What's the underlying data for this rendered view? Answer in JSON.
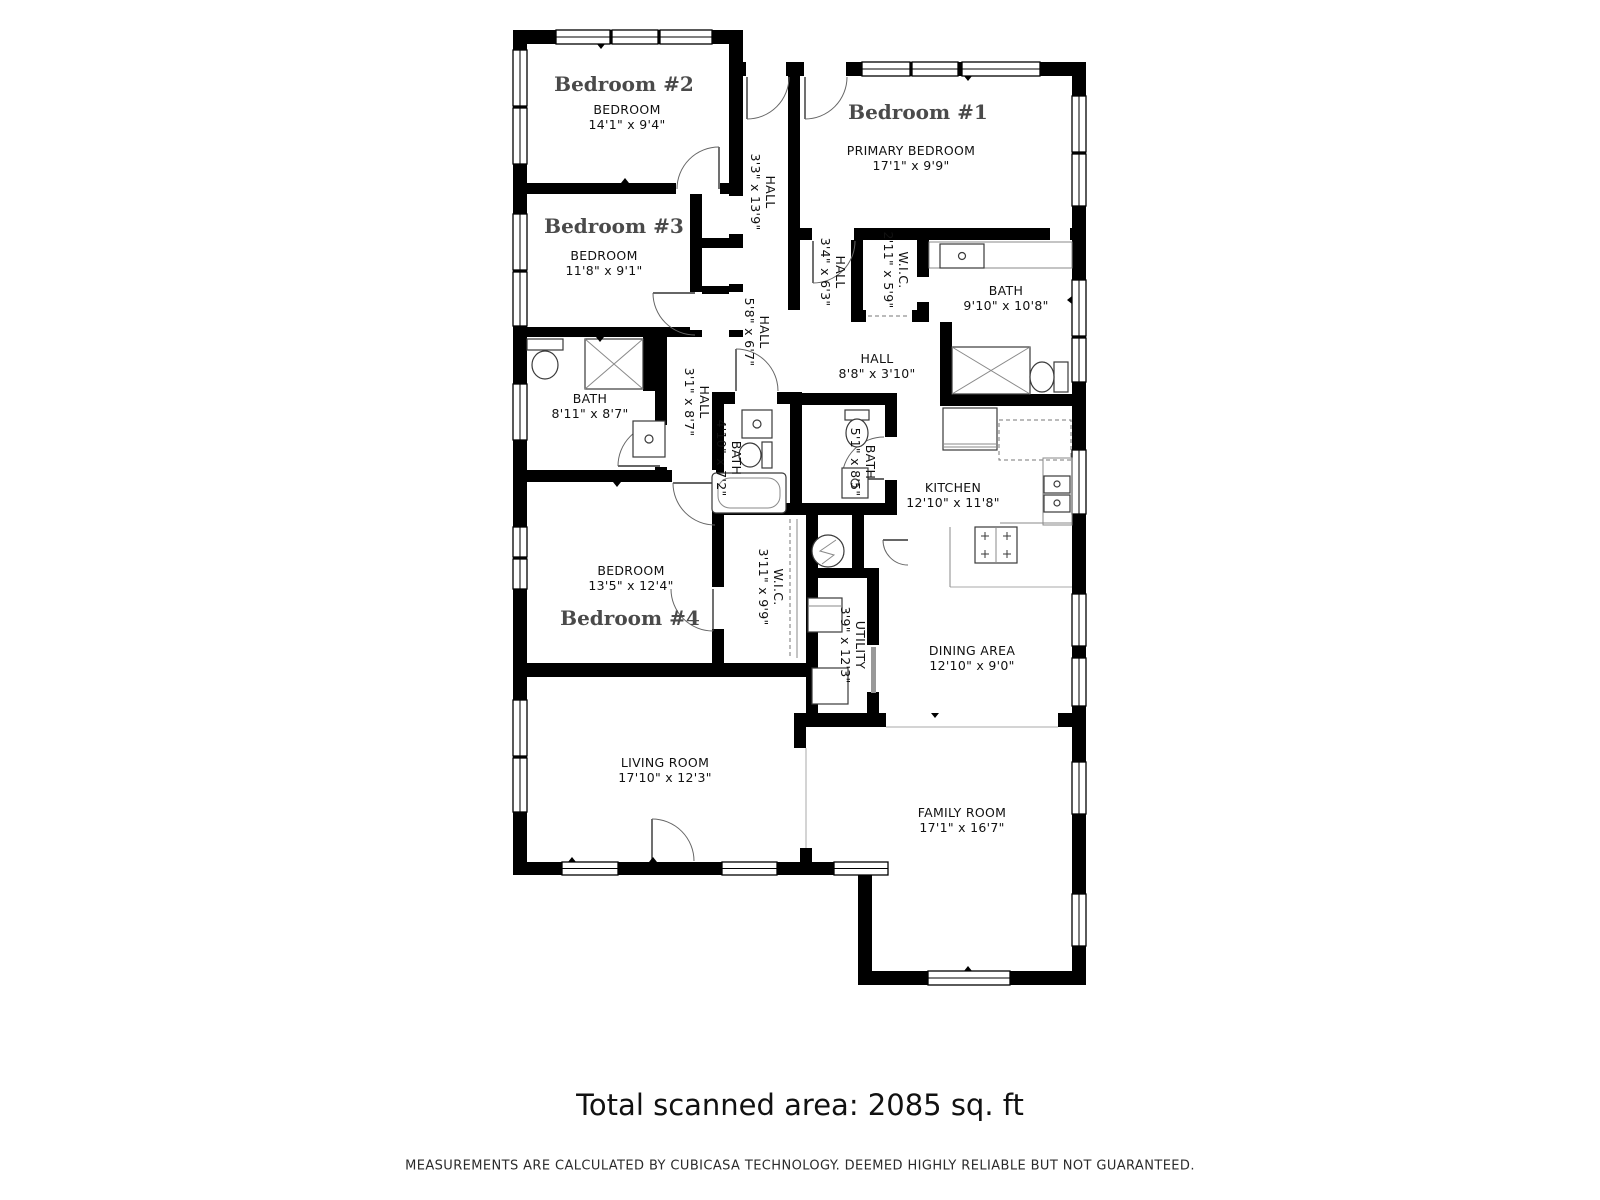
{
  "rooms": {
    "bedroom1": {
      "name": "Bedroom #1",
      "type": "PRIMARY BEDROOM",
      "dims": "17'1\" x 9'9\""
    },
    "bedroom2": {
      "name": "Bedroom #2",
      "type": "BEDROOM",
      "dims": "14'1\" x 9'4\""
    },
    "bedroom3": {
      "name": "Bedroom #3",
      "type": "BEDROOM",
      "dims": "11'8\" x 9'1\""
    },
    "bedroom4": {
      "name": "Bedroom #4",
      "type": "BEDROOM",
      "dims": "13'5\" x 12'4\""
    },
    "hall_main": {
      "type": "HALL",
      "dims": "3'3\" x 13'9\""
    },
    "hall_34": {
      "type": "HALL",
      "dims": "3'4\" x 6'3\""
    },
    "wic_small": {
      "type": "W.I.C.",
      "dims": "2'11\" x 5'9\""
    },
    "bath_primary": {
      "type": "BATH",
      "dims": "9'10\" x 10'8\""
    },
    "hall_58": {
      "type": "HALL",
      "dims": "5'8\" x 6'7\""
    },
    "hall_88": {
      "type": "HALL",
      "dims": "8'8\" x 3'10\""
    },
    "bath_811": {
      "type": "BATH",
      "dims": "8'11\" x 8'7\""
    },
    "hall_31": {
      "type": "HALL",
      "dims": "3'1\" x 8'7\""
    },
    "bath_410": {
      "type": "BATH",
      "dims": "4'10\" x 7'2\""
    },
    "bath_51": {
      "type": "BATH",
      "dims": "5'1\" x 8'5\""
    },
    "kitchen": {
      "type": "KITCHEN",
      "dims": "12'10\" x 11'8\""
    },
    "wic_large": {
      "type": "W.I.C.",
      "dims": "3'11\" x 9'9\""
    },
    "utility": {
      "type": "UTILITY",
      "dims": "3'9\" x 12'3\""
    },
    "dining": {
      "type": "DINING AREA",
      "dims": "12'10\" x 9'0\""
    },
    "living": {
      "type": "LIVING ROOM",
      "dims": "17'10\" x 12'3\""
    },
    "family": {
      "type": "FAMILY ROOM",
      "dims": "17'1\" x 16'7\""
    }
  },
  "footer": {
    "total_area": "Total scanned area: 2085 sq. ft",
    "disclaimer": "MEASUREMENTS ARE CALCULATED BY CUBICASA TECHNOLOGY. DEEMED HIGHLY RELIABLE BUT NOT GUARANTEED."
  },
  "colors": {
    "wall": "#000000",
    "room_name": "#4a4a4a",
    "label": "#111111"
  }
}
